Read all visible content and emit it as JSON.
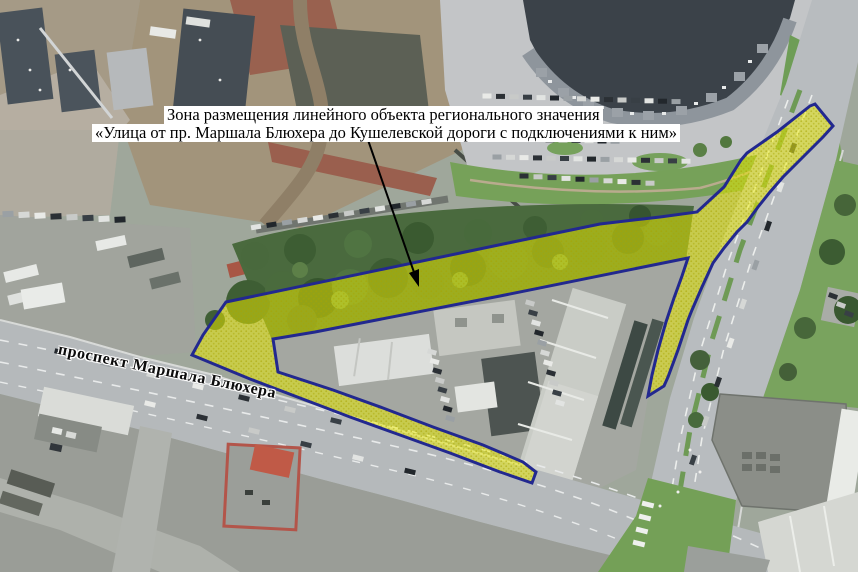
{
  "map": {
    "annotation_line1": "Зона размещения линейного объекта регионального значения",
    "annotation_line2": "«Улица от пр. Маршала Блюхера до Кушелевской дороги с подключениями к ним»",
    "street_label": "проспект Маршала Блюхера",
    "colors": {
      "zone_fill": "#f0f000",
      "zone_dot": "#a8a400",
      "zone_border": "#22288f",
      "arrow": "#000000",
      "label_bg": "#ffffff",
      "label_text": "#000000"
    }
  }
}
